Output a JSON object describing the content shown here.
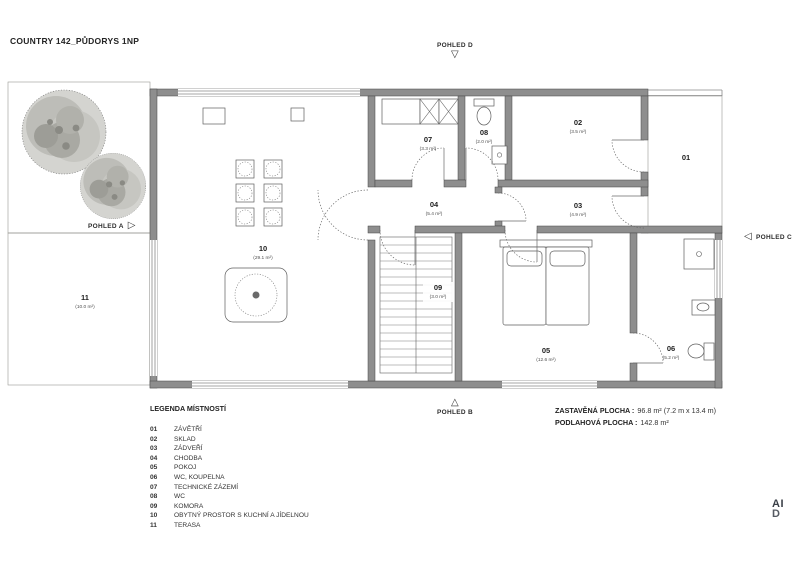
{
  "title": "COUNTRY 142_PŮDORYS 1NP",
  "markers": {
    "a": {
      "label": "POHLED A",
      "icon": "▷"
    },
    "b": {
      "label": "POHLED B",
      "icon": "△"
    },
    "c": {
      "label": "POHLED C",
      "icon": "◁"
    },
    "d": {
      "label": "POHLED D",
      "icon": "▽"
    }
  },
  "rooms": [
    {
      "num": "01",
      "name": "ZÁVĚTŘÍ",
      "area": ""
    },
    {
      "num": "02",
      "name": "SKLAD",
      "area": "(3.5 m²)"
    },
    {
      "num": "03",
      "name": "ZÁDVEŘÍ",
      "area": "(4.9 m²)"
    },
    {
      "num": "04",
      "name": "CHODBA",
      "area": "(5.4 m²)"
    },
    {
      "num": "05",
      "name": "POKOJ",
      "area": "(12.6 m²)"
    },
    {
      "num": "06",
      "name": "WC, KOUPELNA",
      "area": "(5.2 m²)"
    },
    {
      "num": "07",
      "name": "TECHNICKÉ ZÁZEMÍ",
      "area": "(3.3 m²)"
    },
    {
      "num": "08",
      "name": "WC",
      "area": "(2.0 m²)"
    },
    {
      "num": "09",
      "name": "KOMORA",
      "area": "(3.0 m²)"
    },
    {
      "num": "10",
      "name": "OBYTNÝ PROSTOR S KUCHNÍ A JÍDELNOU",
      "area": "(29.1 m²)"
    },
    {
      "num": "11",
      "name": "TERASA",
      "area": "(10.0 m²)"
    }
  ],
  "legend_title": "LEGENDA MÍSTNOSTÍ",
  "summary": {
    "built_label": "ZASTAVĚNÁ PLOCHA :",
    "built_value": "96.8 m² (7.2 m x 13.4 m)",
    "floor_label": "PODLAHOVÁ PLOCHA :",
    "floor_value": "142.8 m²"
  },
  "logo": {
    "line1": "AI",
    "line2": "D"
  },
  "colors": {
    "wall_fill": "#8e8e8e",
    "wood_fill": "#dbcda6",
    "wood_line": "#a79c79",
    "garden_bg": "#f6f6f3",
    "garden_dot": "#c4c4be"
  }
}
